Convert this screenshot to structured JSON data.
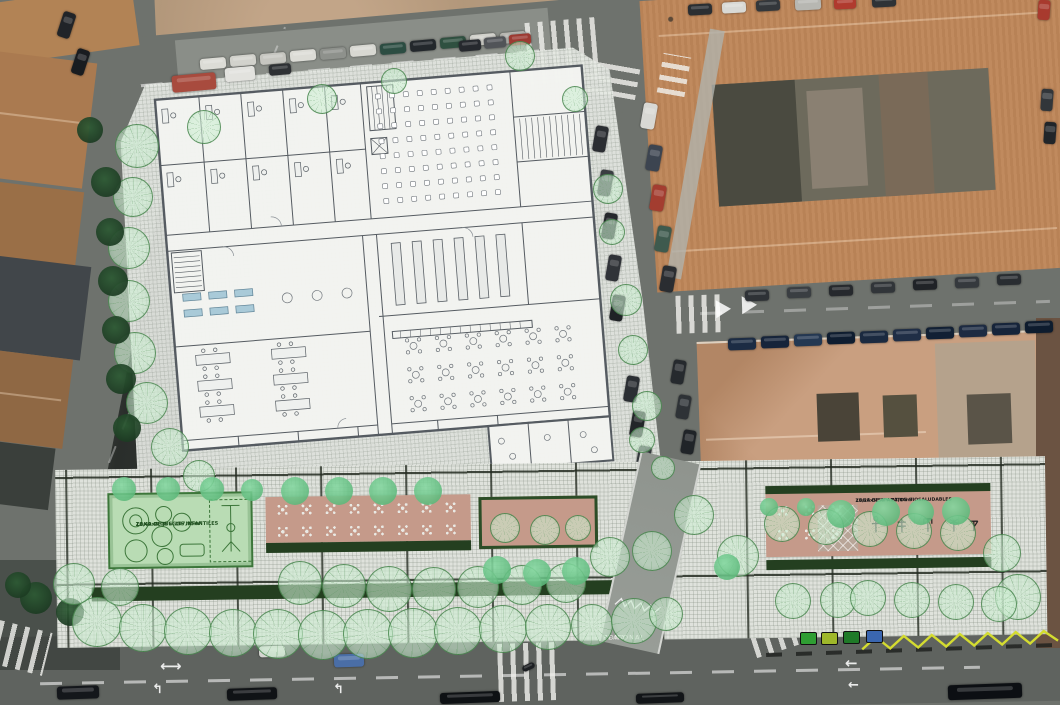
{
  "zones": {
    "playground": {
      "name": "ZONA DE JUEGOS INFANTILES",
      "dims": "13,49x8,00 = 107,95m²"
    },
    "biohealthy": {
      "name": "ZONA DE APARATOS BIOSALUDABLES",
      "dims": "13,28x5,50 = 73,04m²"
    },
    "pedestrian": {
      "line1": "PEATONAL",
      "line2": "ZONA"
    }
  },
  "colors": {
    "road": "#6e726d",
    "roadDark": "#5f635f",
    "dirt": "#b49a7e",
    "roofNE": "#c08a5e",
    "roofSE": "#c99f80",
    "paper": "#f2f3f0",
    "pavement": "#e5e8e3",
    "terrace": "#c59a8a",
    "playground": "#b9dcb4",
    "pgline": "#3c763a",
    "hedge": "#2c4d27",
    "treeSolid": "#4fae6e",
    "zigzag": "#d4dc30",
    "gridDark": "#23281f",
    "planLine": "#555b61"
  },
  "scene": {
    "trees": [
      [
        137,
        146,
        22,
        "h"
      ],
      [
        133,
        197,
        20,
        "h"
      ],
      [
        129,
        248,
        21,
        "h"
      ],
      [
        129,
        301,
        21,
        "h"
      ],
      [
        135,
        353,
        21,
        "h"
      ],
      [
        147,
        403,
        21,
        "h"
      ],
      [
        170,
        447,
        19,
        "h"
      ],
      [
        199,
        476,
        16,
        "h"
      ],
      [
        204,
        127,
        17,
        "h"
      ],
      [
        322,
        99,
        15,
        "h"
      ],
      [
        394,
        81,
        13,
        "h"
      ],
      [
        520,
        56,
        15,
        "h"
      ],
      [
        575,
        99,
        13,
        "h"
      ],
      [
        608,
        189,
        15,
        "h"
      ],
      [
        612,
        232,
        13,
        "h"
      ],
      [
        626,
        300,
        16,
        "h"
      ],
      [
        633,
        350,
        15,
        "h"
      ],
      [
        647,
        406,
        15,
        "h"
      ],
      [
        642,
        440,
        13,
        "h"
      ],
      [
        663,
        468,
        12,
        "h"
      ],
      [
        106,
        182,
        15,
        "d"
      ],
      [
        110,
        232,
        14,
        "d"
      ],
      [
        113,
        281,
        15,
        "d"
      ],
      [
        116,
        330,
        14,
        "d"
      ],
      [
        121,
        379,
        15,
        "d"
      ],
      [
        127,
        428,
        14,
        "d"
      ],
      [
        90,
        130,
        13,
        "d"
      ],
      [
        36,
        598,
        16,
        "d"
      ],
      [
        70,
        612,
        14,
        "d"
      ],
      [
        18,
        585,
        13,
        "d"
      ],
      [
        97,
        622,
        25,
        "h"
      ],
      [
        143,
        628,
        24,
        "h"
      ],
      [
        188,
        631,
        24,
        "h"
      ],
      [
        233,
        633,
        24,
        "h"
      ],
      [
        278,
        634,
        25,
        "h"
      ],
      [
        323,
        635,
        25,
        "h"
      ],
      [
        368,
        634,
        25,
        "h"
      ],
      [
        413,
        633,
        25,
        "h"
      ],
      [
        458,
        631,
        24,
        "h"
      ],
      [
        503,
        629,
        24,
        "h"
      ],
      [
        548,
        627,
        23,
        "h"
      ],
      [
        592,
        625,
        21,
        "h"
      ],
      [
        634,
        621,
        23,
        "h"
      ],
      [
        666,
        614,
        17,
        "h"
      ],
      [
        74,
        584,
        21,
        "h"
      ],
      [
        120,
        587,
        19,
        "h"
      ],
      [
        300,
        583,
        22,
        "h"
      ],
      [
        344,
        586,
        22,
        "h"
      ],
      [
        389,
        589,
        23,
        "h"
      ],
      [
        434,
        589,
        22,
        "h"
      ],
      [
        478,
        587,
        21,
        "h"
      ],
      [
        522,
        585,
        20,
        "h"
      ],
      [
        566,
        583,
        20,
        "h"
      ],
      [
        610,
        557,
        20,
        "h"
      ],
      [
        652,
        551,
        20,
        "h"
      ],
      [
        694,
        515,
        20,
        "h"
      ],
      [
        738,
        556,
        21,
        "h"
      ],
      [
        505,
        528,
        15,
        "h"
      ],
      [
        545,
        530,
        15,
        "h"
      ],
      [
        578,
        528,
        13,
        "h"
      ],
      [
        782,
        524,
        18,
        "h"
      ],
      [
        826,
        527,
        18,
        "h"
      ],
      [
        870,
        529,
        18,
        "h"
      ],
      [
        914,
        531,
        18,
        "h"
      ],
      [
        958,
        533,
        18,
        "h"
      ],
      [
        1002,
        553,
        19,
        "h"
      ],
      [
        1018,
        597,
        23,
        "h"
      ],
      [
        793,
        601,
        18,
        "h"
      ],
      [
        838,
        600,
        18,
        "h"
      ],
      [
        868,
        598,
        18,
        "h"
      ],
      [
        912,
        600,
        18,
        "h"
      ],
      [
        956,
        602,
        18,
        "h"
      ],
      [
        999,
        604,
        18,
        "h"
      ],
      [
        295,
        491,
        14,
        "s"
      ],
      [
        339,
        491,
        14,
        "s"
      ],
      [
        383,
        491,
        14,
        "s"
      ],
      [
        428,
        491,
        14,
        "s"
      ],
      [
        124,
        489,
        12,
        "s"
      ],
      [
        168,
        489,
        12,
        "s"
      ],
      [
        212,
        489,
        12,
        "s"
      ],
      [
        252,
        490,
        11,
        "s"
      ],
      [
        497,
        570,
        14,
        "s"
      ],
      [
        537,
        573,
        14,
        "s"
      ],
      [
        576,
        571,
        14,
        "s"
      ],
      [
        727,
        567,
        13,
        "s"
      ],
      [
        769,
        507,
        9,
        "s"
      ],
      [
        806,
        507,
        9,
        "s"
      ],
      [
        841,
        514,
        14,
        "s"
      ],
      [
        886,
        512,
        14,
        "s"
      ],
      [
        921,
        512,
        13,
        "s"
      ],
      [
        956,
        511,
        14,
        "s"
      ]
    ],
    "cars": [
      [
        213,
        63,
        26,
        11,
        "#dcdcd6",
        -5
      ],
      [
        243,
        60,
        26,
        11,
        "#d2d2cc",
        -5
      ],
      [
        273,
        58,
        26,
        11,
        "#c6c6c0",
        -5
      ],
      [
        303,
        55,
        26,
        11,
        "#dcdcd6",
        -5
      ],
      [
        333,
        53,
        26,
        11,
        "#8e918c",
        -5
      ],
      [
        363,
        50,
        26,
        11,
        "#d8d8d2",
        -5
      ],
      [
        393,
        48,
        26,
        11,
        "#2c4d42",
        -5
      ],
      [
        423,
        45,
        26,
        11,
        "#23282c",
        -5
      ],
      [
        453,
        42,
        26,
        11,
        "#2f5040",
        -5
      ],
      [
        483,
        39,
        26,
        11,
        "#d2d2cc",
        -5
      ],
      [
        513,
        37,
        26,
        11,
        "#b8b8b2",
        -5
      ],
      [
        194,
        82,
        44,
        17,
        "#a84b3e",
        -5
      ],
      [
        240,
        74,
        30,
        14,
        "#e2e2de",
        -5
      ],
      [
        280,
        69,
        22,
        11,
        "#2e3134",
        -5
      ],
      [
        470,
        45,
        22,
        11,
        "#26292e",
        -5
      ],
      [
        495,
        42,
        22,
        11,
        "#515458",
        -5
      ],
      [
        520,
        39,
        22,
        11,
        "#9c3a32",
        -5
      ],
      [
        600,
        139,
        13,
        26,
        "#2b2e32",
        10
      ],
      [
        605,
        183,
        13,
        26,
        "#3a3e42",
        10
      ],
      [
        609,
        226,
        13,
        26,
        "#25282c",
        10
      ],
      [
        613,
        268,
        13,
        26,
        "#303338",
        10
      ],
      [
        617,
        308,
        13,
        26,
        "#1f2226",
        10
      ],
      [
        631,
        389,
        13,
        26,
        "#2b2f33",
        10
      ],
      [
        637,
        424,
        13,
        26,
        "#232629",
        10
      ],
      [
        643,
        459,
        13,
        26,
        "#34383c",
        10
      ],
      [
        649,
        116,
        14,
        26,
        "#d8d8d4",
        10
      ],
      [
        654,
        158,
        14,
        26,
        "#3c4450",
        10
      ],
      [
        658,
        198,
        14,
        26,
        "#a33d30",
        10
      ],
      [
        663,
        239,
        14,
        26,
        "#3e5a4e",
        10
      ],
      [
        668,
        279,
        14,
        26,
        "#2a2d31",
        10
      ],
      [
        678,
        372,
        13,
        24,
        "#262a2e",
        10
      ],
      [
        683,
        407,
        13,
        24,
        "#2e3236",
        10
      ],
      [
        688,
        442,
        13,
        24,
        "#202428",
        10
      ],
      [
        700,
        9,
        24,
        11,
        "#2a2e32",
        -3
      ],
      [
        734,
        7,
        24,
        11,
        "#d9d9d5",
        -3
      ],
      [
        768,
        5,
        24,
        11,
        "#33373b",
        -3
      ],
      [
        808,
        4,
        26,
        12,
        "#b7b7b2",
        -3
      ],
      [
        845,
        3,
        22,
        11,
        "#b03a2e",
        -3
      ],
      [
        884,
        1,
        24,
        11,
        "#2e3236",
        -3
      ],
      [
        1044,
        10,
        12,
        20,
        "#a83a2e",
        4
      ],
      [
        1047,
        100,
        12,
        22,
        "#32363a",
        4
      ],
      [
        1050,
        133,
        12,
        22,
        "#212529",
        4
      ],
      [
        742,
        344,
        28,
        12,
        "#1c2c44",
        -2
      ],
      [
        775,
        342,
        28,
        12,
        "#16243a",
        -2
      ],
      [
        808,
        340,
        28,
        12,
        "#243852",
        -2
      ],
      [
        841,
        338,
        28,
        12,
        "#0f1d30",
        -2
      ],
      [
        874,
        337,
        28,
        12,
        "#1b2a40",
        -2
      ],
      [
        907,
        335,
        28,
        12,
        "#202e46",
        -2
      ],
      [
        940,
        333,
        28,
        12,
        "#122034",
        -2
      ],
      [
        973,
        331,
        28,
        12,
        "#1d2b42",
        -2
      ],
      [
        1006,
        329,
        28,
        12,
        "#16243a",
        -2
      ],
      [
        1039,
        327,
        28,
        12,
        "#0e1c2e",
        -2
      ],
      [
        757,
        295,
        24,
        11,
        "#2e3236",
        -2
      ],
      [
        799,
        292,
        24,
        11,
        "#3a3e42",
        -2
      ],
      [
        841,
        290,
        24,
        11,
        "#26292d",
        -2
      ],
      [
        883,
        287,
        24,
        11,
        "#313539",
        -2
      ],
      [
        925,
        284,
        24,
        11,
        "#202327",
        -2
      ],
      [
        967,
        282,
        24,
        11,
        "#35393d",
        -2
      ],
      [
        1009,
        279,
        24,
        11,
        "#292d31",
        -2
      ],
      [
        272,
        651,
        26,
        11,
        "#d6d6d2",
        -2
      ],
      [
        349,
        660,
        30,
        13,
        "#4a6ea6",
        -2
      ],
      [
        528,
        667,
        13,
        6,
        "#1c1f22",
        -25
      ],
      [
        78,
        692,
        42,
        13,
        "#14171b",
        -2
      ],
      [
        252,
        694,
        50,
        12,
        "#101316",
        -2
      ],
      [
        470,
        697,
        60,
        11,
        "#0e1114",
        -2
      ],
      [
        660,
        698,
        48,
        10,
        "#121518",
        -2
      ],
      [
        985,
        691,
        74,
        15,
        "#0c0f13",
        -2
      ],
      [
        66,
        25,
        13,
        26,
        "#212428",
        18
      ],
      [
        80,
        62,
        13,
        26,
        "#191c20",
        18
      ]
    ],
    "crosswalks": [
      [
        527,
        20,
        70,
        62,
        -5,
        "v"
      ],
      [
        588,
        64,
        50,
        32,
        10,
        "h"
      ],
      [
        660,
        55,
        28,
        40,
        10,
        "h"
      ],
      [
        676,
        295,
        46,
        38,
        -2,
        "v"
      ],
      [
        498,
        643,
        58,
        58,
        -2,
        "v"
      ],
      [
        -6,
        626,
        54,
        44,
        14,
        "v"
      ],
      [
        752,
        626,
        44,
        26,
        -18,
        "v"
      ]
    ],
    "arrows": [
      [
        160,
        659,
        "⟷",
        0,
        15
      ],
      [
        152,
        683,
        "↰",
        0,
        13
      ],
      [
        333,
        683,
        "↰",
        0,
        13
      ],
      [
        845,
        656,
        "←",
        0,
        15
      ],
      [
        848,
        679,
        "←",
        0,
        13
      ]
    ],
    "containers": [
      {
        "x": 800,
        "y": 632,
        "color": "#2f9e33"
      },
      {
        "x": 821,
        "y": 632,
        "color": "#9fb82a"
      },
      {
        "x": 843,
        "y": 631,
        "color": "#1f7a28"
      },
      {
        "x": 866,
        "y": 630,
        "color": "#3a66b0"
      }
    ],
    "tablesA": {
      "x0": 222,
      "y0": 38,
      "cols": 8,
      "rows": 2,
      "dx": 24,
      "dy": 22
    },
    "tablesC": {
      "x0": 722,
      "y0": 46,
      "cols": 3,
      "rows": 2,
      "dx": 27,
      "dy": 24
    },
    "plan": {
      "aud": {
        "x0": 224,
        "y0": 16,
        "cols": 9,
        "rows": 8,
        "dx": 14,
        "dy": 15
      },
      "library": {
        "x0": 228,
        "y0": 166,
        "cols": 6,
        "dx": 21,
        "w": 9,
        "h": 62
      },
      "cafe": {
        "x0": 242,
        "y0": 270,
        "cols": 6,
        "rows": 3,
        "dx": 30,
        "dy": 29
      },
      "desks": {
        "xs": [
          10,
          54,
          96,
          138,
          180
        ],
        "ys": [
          14,
          78
        ]
      },
      "rectTables": {
        "xs": [
          24,
          100
        ],
        "ys": [
          262,
          288,
          314
        ]
      }
    }
  }
}
